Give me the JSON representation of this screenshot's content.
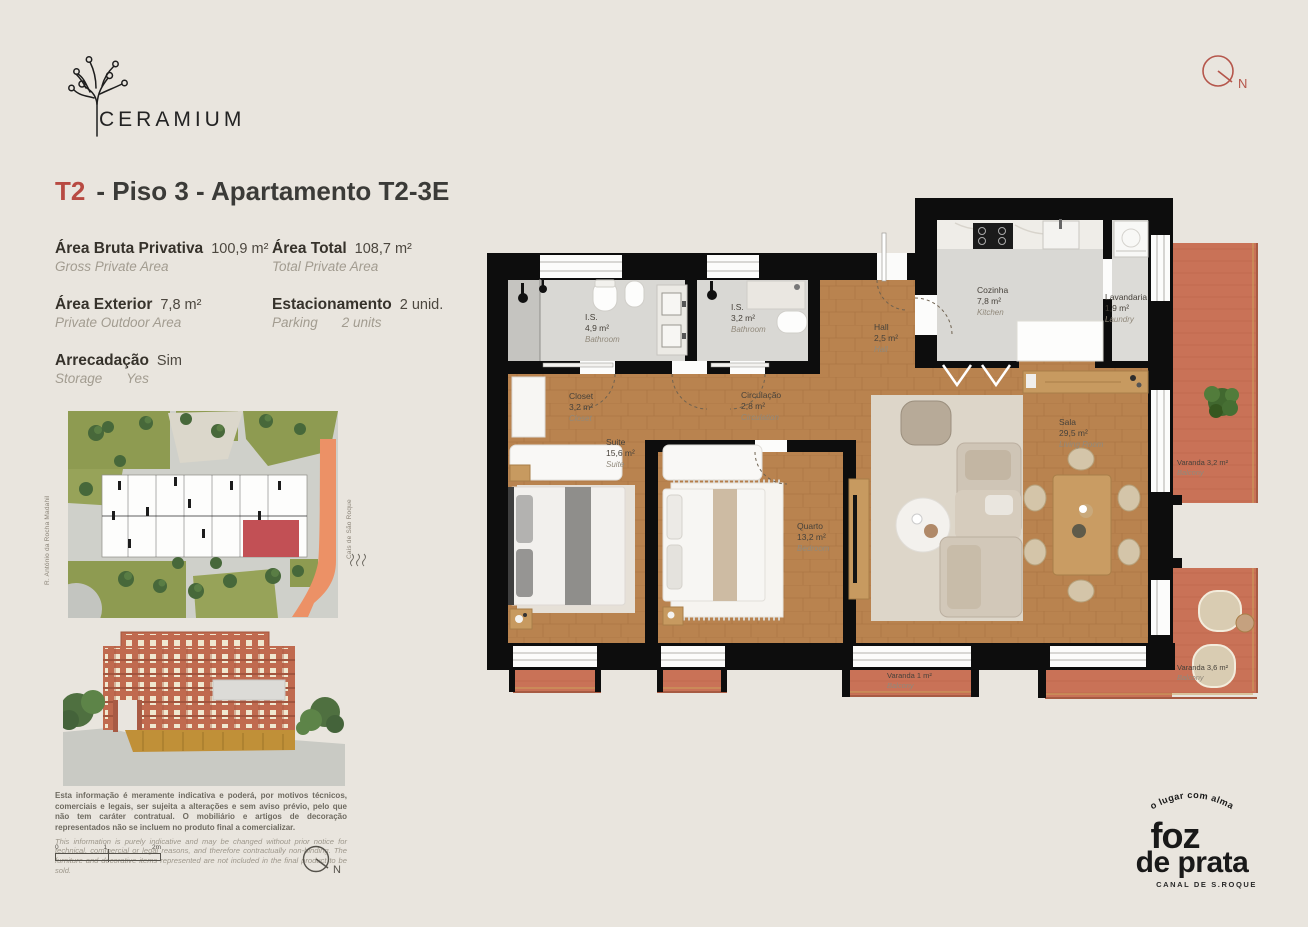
{
  "brand": {
    "name": "CERAMIUM"
  },
  "header_compass": {
    "label": "N"
  },
  "title": {
    "typology": "T2",
    "rest": "-  Piso 3 - Apartamento T2-3E"
  },
  "specs": {
    "items": [
      {
        "label": "Área Bruta Privativa",
        "value": "100,9 m²",
        "sublabel": "Gross Private Area",
        "subvalue": ""
      },
      {
        "label": "Área Total",
        "value": "108,7 m²",
        "sublabel": "Total Private Area",
        "subvalue": ""
      },
      {
        "label": "Área Exterior",
        "value": "7,8 m²",
        "sublabel": "Private Outdoor Area",
        "subvalue": ""
      },
      {
        "label": "Estacionamento",
        "value": "2 unid.",
        "sublabel": "Parking",
        "subvalue": "2 units"
      },
      {
        "label": "Arrecadação",
        "value": "Sim",
        "sublabel": "Storage",
        "subvalue": "Yes"
      }
    ]
  },
  "site_plan": {
    "street_left": "R. António da Rocha Madahil",
    "street_right": "Cais de São Roque"
  },
  "plan": {
    "rooms": [
      {
        "name": "I.S.",
        "area": "4,9 m²",
        "en": "Bathroom"
      },
      {
        "name": "I.S.",
        "area": "3,2 m²",
        "en": "Bathroom"
      },
      {
        "name": "Hall",
        "area": "2,5 m²",
        "en": "Hall"
      },
      {
        "name": "Cozinha",
        "area": "7,8 m²",
        "en": "Kitchen"
      },
      {
        "name": "Lavandaria",
        "area": "1,9 m²",
        "en": "Laundry"
      },
      {
        "name": "Closet",
        "area": "3,2 m²",
        "en": "Closet"
      },
      {
        "name": "Circulação",
        "area": "2,8 m²",
        "en": "Circulation"
      },
      {
        "name": "Suite",
        "area": "15,6 m²",
        "en": "Suite"
      },
      {
        "name": "Quarto",
        "area": "13,2 m²",
        "en": "Bedroom"
      },
      {
        "name": "Sala",
        "area": "29,5 m²",
        "en": "Living Room"
      },
      {
        "name": "Varanda 3,2 m²",
        "en": "Balcony"
      },
      {
        "name": "Varanda 3,6 m²",
        "en": "Balcony"
      },
      {
        "name": "Varanda 1 m²",
        "en": "Balcony"
      }
    ]
  },
  "disclaimer": {
    "pt": "Esta informação é meramente indicativa e poderá, por motivos técnicos, comerciais e legais, ser sujeita a alterações e sem aviso prévio, pelo que não tem caráter contratual. O mobiliário e artigos de decoração representados não se incluem no produto final a comercializar.",
    "en": "This information is purely indicative and may be changed without prior notice for technical, commercial or legal reasons, and therefore contractually non-binding. The furniture and decorative items represented are not included in the final product to be sold."
  },
  "scale_bar": {
    "t0": "0",
    "t1": "1",
    "t2": "2m"
  },
  "footer_compass": {
    "label": "N"
  },
  "footer_logo": {
    "tagline": "o lugar com alma",
    "word1": "foz",
    "word2": "de prata",
    "subtitle": "CANAL DE S.ROQUE"
  },
  "colors": {
    "accent_red": "#b84a42",
    "terracotta": "#c97257",
    "wood": "#b9834f",
    "wall_black": "#0d0d0d",
    "grey_floor": "#d9d8d4",
    "background": "#e9e5de"
  }
}
